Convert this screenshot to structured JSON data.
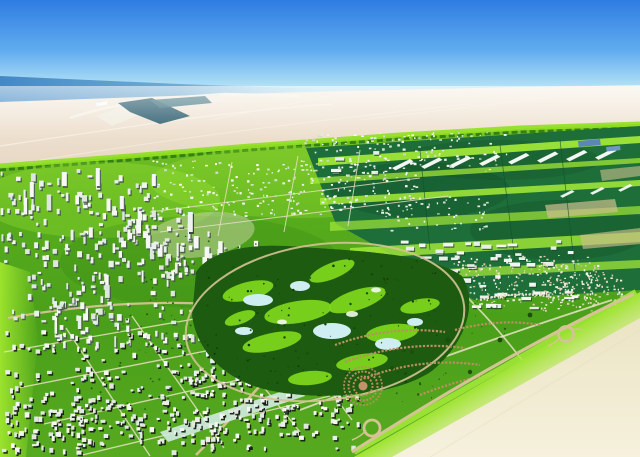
{
  "scene": {
    "description": "Aerial artist rendering of a desert master-planned city: blue sky over the sea, a coastal port with breakwater, a wide sand desert, a vast green development with white residential districts and towers, airport logistics fields with white hangar strips, a central golf course with lakes, villa crescents, and a highway with roundabouts meeting open desert at the lower right.",
    "regions": [
      {
        "name": "sky"
      },
      {
        "name": "sea"
      },
      {
        "name": "coastal-port"
      },
      {
        "name": "north-desert"
      },
      {
        "name": "greenbelt-development"
      },
      {
        "name": "airport-logistics-fields"
      },
      {
        "name": "north-residential-grid"
      },
      {
        "name": "west-city-towers"
      },
      {
        "name": "golf-course"
      },
      {
        "name": "southwest-urban-blocks"
      },
      {
        "name": "southeast-villa-crescents"
      },
      {
        "name": "southeast-desert"
      },
      {
        "name": "boundary-highway"
      }
    ]
  },
  "palette": {
    "sky_top": "#2e7ce2",
    "sky_low": "#bfe8f6",
    "sea_deep": "#4488c4",
    "port_water": "#27596b",
    "desert_sand": "#f0e5d4",
    "desert_se": "#f4efdb",
    "green_base": "#54aa1d",
    "green_bright": "#8fe01f",
    "green_lime": "#a6ec38",
    "field_teal": "#1e6e3a",
    "golf_dark": "#1d5c10",
    "fairway": "#7cd41c",
    "water_feature": "#cfeef2",
    "building_white": "#f4f6f2",
    "road_tan": "#d4c394",
    "road_light": "#e9e2c4",
    "villa_tan": "#bb8f60",
    "tree_dark": "#2c6d14",
    "blue_roof": "#5b87b5"
  },
  "render": {
    "scatter": {
      "city_towers": {
        "seed": 11,
        "count": 380,
        "boxes": [
          [
            0,
            168,
            150,
            78
          ],
          [
            0,
            238,
            128,
            85
          ],
          [
            88,
            206,
            122,
            78
          ],
          [
            148,
            238,
            112,
            62
          ],
          [
            40,
            298,
            130,
            55
          ],
          [
            205,
            255,
            95,
            45
          ],
          [
            165,
            300,
            120,
            45
          ]
        ],
        "w": [
          1.8,
          5.2
        ],
        "h": [
          2,
          7
        ],
        "tall": 0.18,
        "fills": [
          "#f5f7f3",
          "#eaf0ea",
          "#dde7e0"
        ],
        "sh": [
          1.3,
          1.5,
          "#45544e",
          0.85
        ]
      },
      "north_grid": {
        "seed": 7,
        "count": 430,
        "boxes": [
          [
            150,
            160,
            270,
            58
          ],
          [
            300,
            132,
            210,
            40
          ],
          [
            380,
            196,
            110,
            36
          ]
        ],
        "w": [
          1.2,
          3
        ],
        "h": [
          1,
          2.4
        ],
        "fills": [
          "#f2f5ef",
          "#e6ece4",
          "#f7f9f5",
          "#cfdcc8"
        ]
      },
      "hangars": {
        "seed": 5,
        "count": 72,
        "boxes": [
          [
            395,
            240,
            180,
            48
          ],
          [
            470,
            290,
            110,
            22
          ],
          [
            330,
            150,
            55,
            28
          ]
        ],
        "w": [
          5,
          11
        ],
        "h": [
          2.2,
          4.2
        ],
        "fills": [
          "#f4f6f1",
          "#e9efe8"
        ],
        "sh": [
          1,
          1.2,
          "#1d4a2a",
          0.8
        ]
      },
      "medina": {
        "seed": 9,
        "count": 380,
        "boxes": [
          [
            452,
            255,
            148,
            52
          ],
          [
            540,
            272,
            85,
            40
          ]
        ],
        "w": [
          1.1,
          2.4
        ],
        "h": [
          1,
          2.2
        ],
        "fills": [
          "#f1efe4",
          "#e2d8bd",
          "#d8cba6",
          "#f6f4ea"
        ]
      },
      "sw_urban": {
        "seed": 3,
        "count": 520,
        "boxes": [
          [
            5,
            330,
            250,
            120
          ],
          [
            180,
            362,
            180,
            90
          ],
          [
            228,
            300,
            150,
            75
          ],
          [
            0,
            398,
            180,
            58
          ],
          [
            250,
            380,
            95,
            60
          ]
        ],
        "w": [
          2,
          5
        ],
        "h": [
          2,
          5.5
        ],
        "fills": [
          "#f4f6f2",
          "#e9eee8",
          "#dfe7df"
        ],
        "sh": [
          1.4,
          1.6,
          "#10180f",
          0.9
        ]
      },
      "belt_trees": {
        "seed": 13,
        "count": 160,
        "dot": true,
        "boxes": [
          [
            140,
            235,
            130,
            70
          ],
          [
            110,
            300,
            110,
            55
          ],
          [
            420,
            295,
            90,
            45
          ],
          [
            320,
            355,
            130,
            55
          ],
          [
            90,
            360,
            80,
            50
          ]
        ],
        "w": [
          1,
          2.4
        ],
        "h": [
          1,
          2.4
        ],
        "fills": [
          "#2c6d14",
          "#235c10"
        ]
      },
      "golf_trees": {
        "seed": 17,
        "count": 140,
        "dot": true,
        "boxes": [
          [
            200,
            256,
            254,
            128
          ]
        ],
        "w": [
          1,
          2.6
        ],
        "h": [
          1,
          2.6
        ],
        "fills": [
          "#123f07",
          "#1a4d0a"
        ]
      }
    }
  }
}
